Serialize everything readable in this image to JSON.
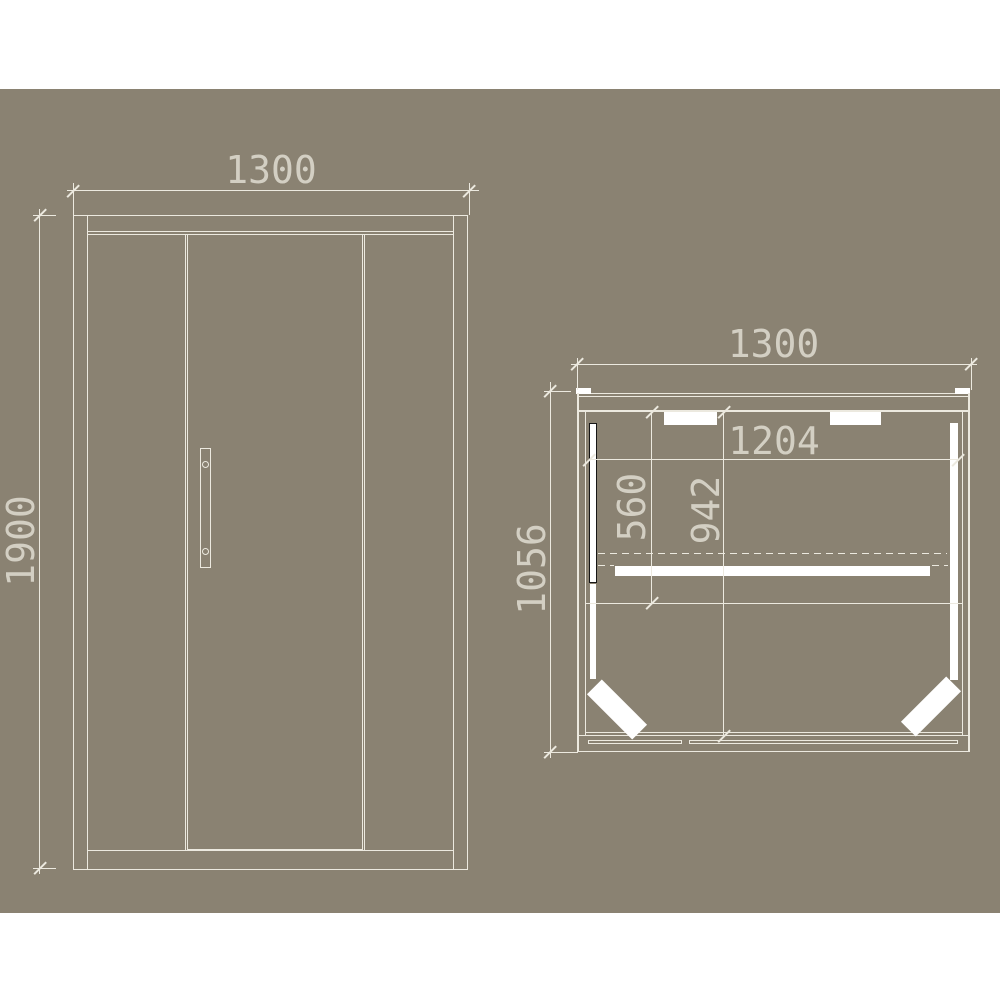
{
  "meta": {
    "kind": "cad-orthographic-drawing",
    "subject": "sliding-door cabin shown as front elevation and plan view, dimensions in mm"
  },
  "colors": {
    "page": "#ffffff",
    "canvas": "#8a8272",
    "line": "#ece9df",
    "text": "#d3cfc3",
    "white": "#ffffff",
    "black": "#161616"
  },
  "drawing": {
    "front_view": {
      "title": "front-elevation",
      "width_label": "1300",
      "height_label": "1900"
    },
    "plan_view": {
      "title": "plan-view",
      "width_label": "1300",
      "depth_label": "1056",
      "interior_width_label": "1204",
      "seat_depth_label": "560",
      "interior_depth_label": "942"
    }
  }
}
